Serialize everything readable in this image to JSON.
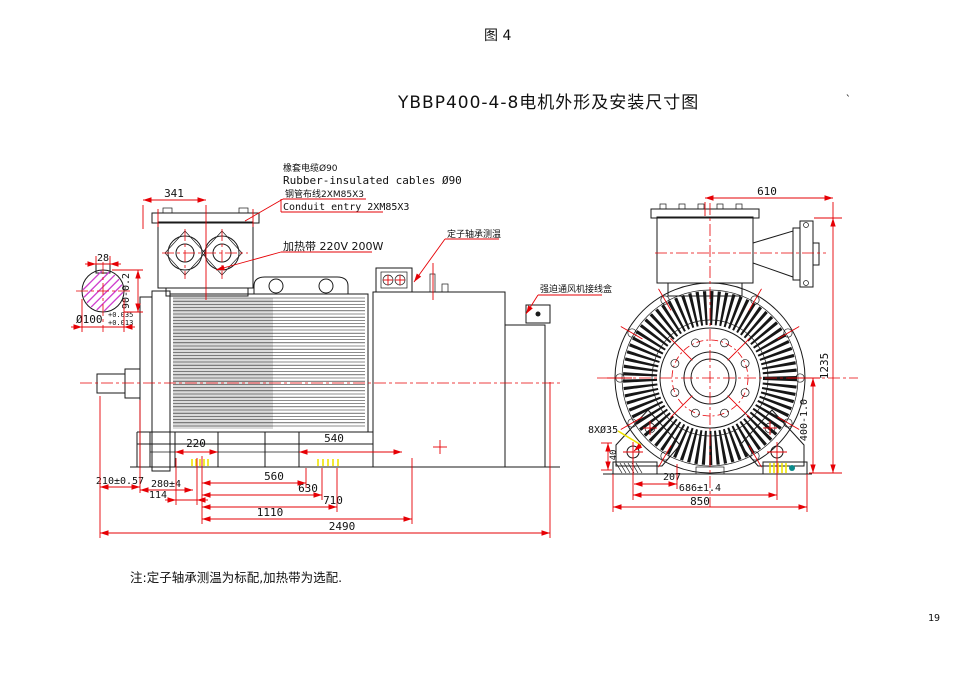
{
  "page": {
    "figure_label": "图 4",
    "page_number": "19"
  },
  "title": {
    "text": "YBBP400-4-8电机外形及安装尺寸图",
    "tick": "`"
  },
  "colors": {
    "line": "#1a1a1a",
    "dimension": "#e60005",
    "hatch": "#cf3fcf",
    "highlight": "#f0e400",
    "accent_dot": "#0a8a8a"
  },
  "annotations": {
    "cable_cn": "橡套电缆Ø90",
    "cable_en": "Rubber-insulated cables Ø90",
    "conduit_cn": "钢管布线2XM85X3",
    "conduit_en": "Conduit entry 2XM85X3",
    "heater": "加热带 220V 200W",
    "bearing_temp": "定子轴承测温",
    "fan_junction_box": "强迫通风机接线盒",
    "note": "注:定子轴承测温为标配,加热带为选配."
  },
  "side_view": {
    "dims": {
      "terminal_box_width": "341",
      "key_width": "28",
      "key_height": "90-0.2",
      "shaft_dia": "Ø100",
      "shaft_tol_upper": "+0.035",
      "shaft_tol_lower": "+0.013",
      "foot_pad_front": "220",
      "foot_pad_rear": "540",
      "shaft_extension": "210±0.57",
      "front_overhang": "280±4",
      "dim_114": "114",
      "dim_560": "560",
      "dim_630": "630",
      "dim_710": "710",
      "foot_span": "1110",
      "total_length": "2490"
    }
  },
  "front_view": {
    "dims": {
      "box_width": "610",
      "total_height": "1235",
      "shaft_height": "400-1.0",
      "foot_holes": "8XØ35",
      "pad_height": "40",
      "dim_207": "207",
      "foot_hole_span": "686±1.4",
      "base_width": "850"
    }
  }
}
